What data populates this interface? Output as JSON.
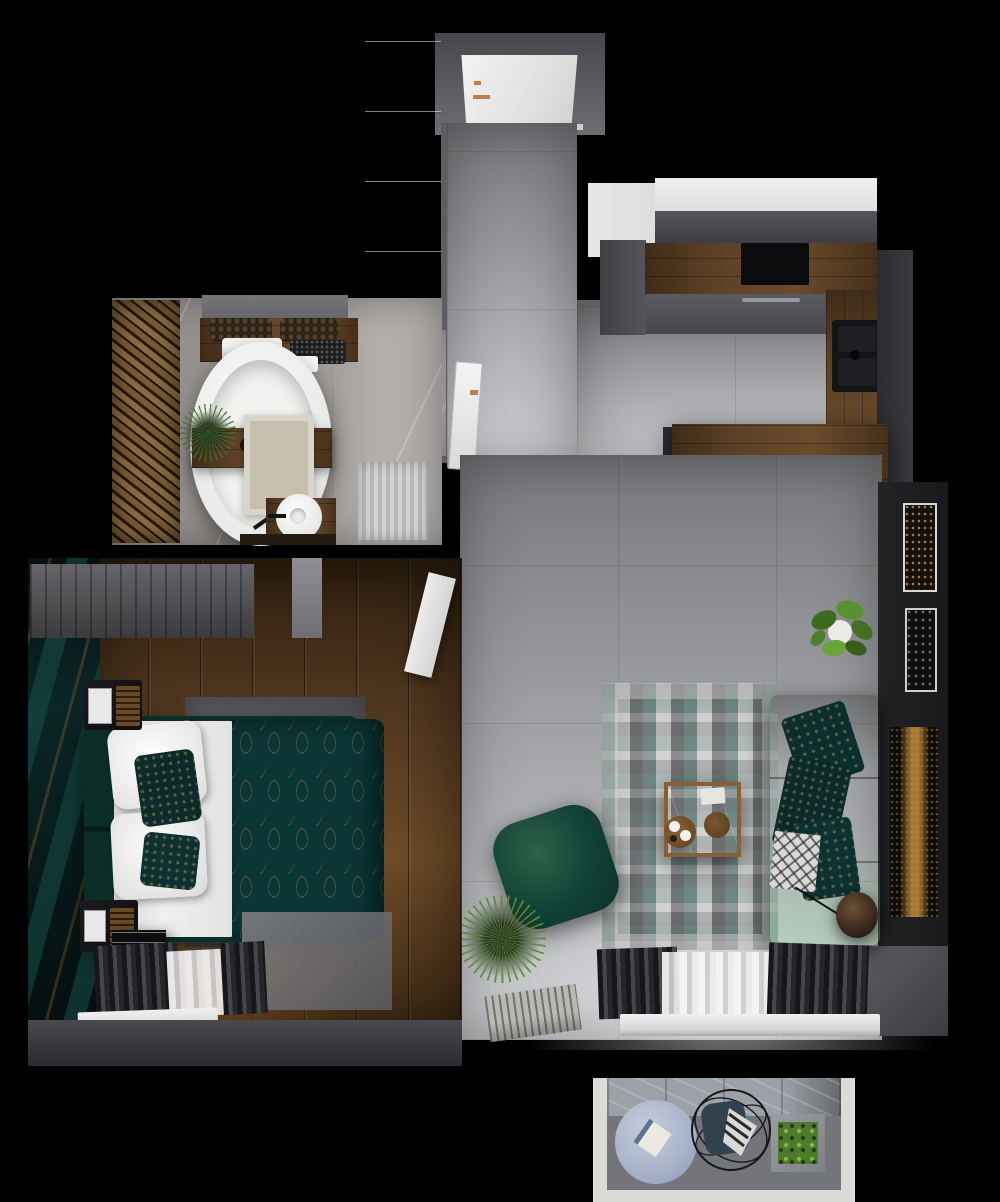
{
  "palette": {
    "bg": "#000000",
    "wallDark": "#1d1d20",
    "wallGray": "#55555a",
    "wallLight": "#8a8a8e",
    "concrete": "#9fa0a3",
    "concreteDark": "#77787b",
    "concreteLight": "#c9cacd",
    "marble": "#94908e",
    "marbleLight": "#b2aeac",
    "woodFloor": "#4e351e",
    "woodFloorLight": "#6e4c28",
    "woodCounter": "#5d4126",
    "woodSlatA": "#8a6a40",
    "woodSlatB": "#241a0f",
    "white": "#e9e9e9",
    "offWhite": "#d9d9d9",
    "green": "#124237",
    "greenDark": "#0b2f27",
    "greenLight": "#2f6247",
    "tealFabric": "#0c3536",
    "gold": "#b08a46",
    "copper": "#c07d45",
    "blueRug": "#a7b2c9",
    "cushionBlue": "#33414e",
    "plantGreen": "#5d8a33",
    "plantDark": "#33511e",
    "rugGrayTeal": "#a8aaa8",
    "lampBronze": "#4a3526"
  },
  "scene": {
    "description": "Top-down 3D render of a one-bedroom apartment floor plan",
    "rooms": [
      {
        "name": "hallway",
        "items": [
          "entrance-door",
          "brass-door-handle",
          "white-wardrobe",
          "leaning-mirror",
          "concrete-floor"
        ]
      },
      {
        "name": "kitchen",
        "items": [
          "white-upper-cabinets",
          "fridge-column",
          "wood-countertop",
          "induction-hob",
          "oven",
          "black-sink",
          "tall-dark-cabinet",
          "window-strip",
          "breakfast-bar",
          "bar-stool",
          "bar-stool",
          "bar-stool",
          "copper-coasters"
        ]
      },
      {
        "name": "bathroom",
        "items": [
          "wood-slat-wall",
          "mirror",
          "vanity",
          "baskets",
          "white-towels",
          "dark-towels",
          "toilet",
          "freestanding-bathtub",
          "bath-caddy",
          "bath-plant",
          "beige-rug",
          "vessel-sink",
          "shower",
          "wood-shelf"
        ]
      },
      {
        "name": "bedroom",
        "items": [
          "teal-gold-wall-mural",
          "gray-wardrobe-curtain",
          "double-bed",
          "green-headboard",
          "white-pillows",
          "patterned-pillows",
          "teal-gold-duvet",
          "gray-rug",
          "nightstand",
          "nightstand",
          "book-stack",
          "window-curtains",
          "window-sill",
          "open-door"
        ]
      },
      {
        "name": "living-room",
        "items": [
          "distressed-rug",
          "green-sofa",
          "patterned-cushions",
          "diamond-throw",
          "coffee-table",
          "wood-tray",
          "green-pouf",
          "spiky-plant",
          "potted-plant",
          "doormat",
          "floor-lamp",
          "window-curtains",
          "window-sill",
          "wall-art",
          "wall-art",
          "gold-streak-art"
        ]
      },
      {
        "name": "balcony",
        "items": [
          "white-frame",
          "stone-wall",
          "round-blue-rug",
          "book",
          "wire-chair",
          "blue-cushion",
          "striped-throw",
          "square-planter"
        ]
      }
    ]
  }
}
